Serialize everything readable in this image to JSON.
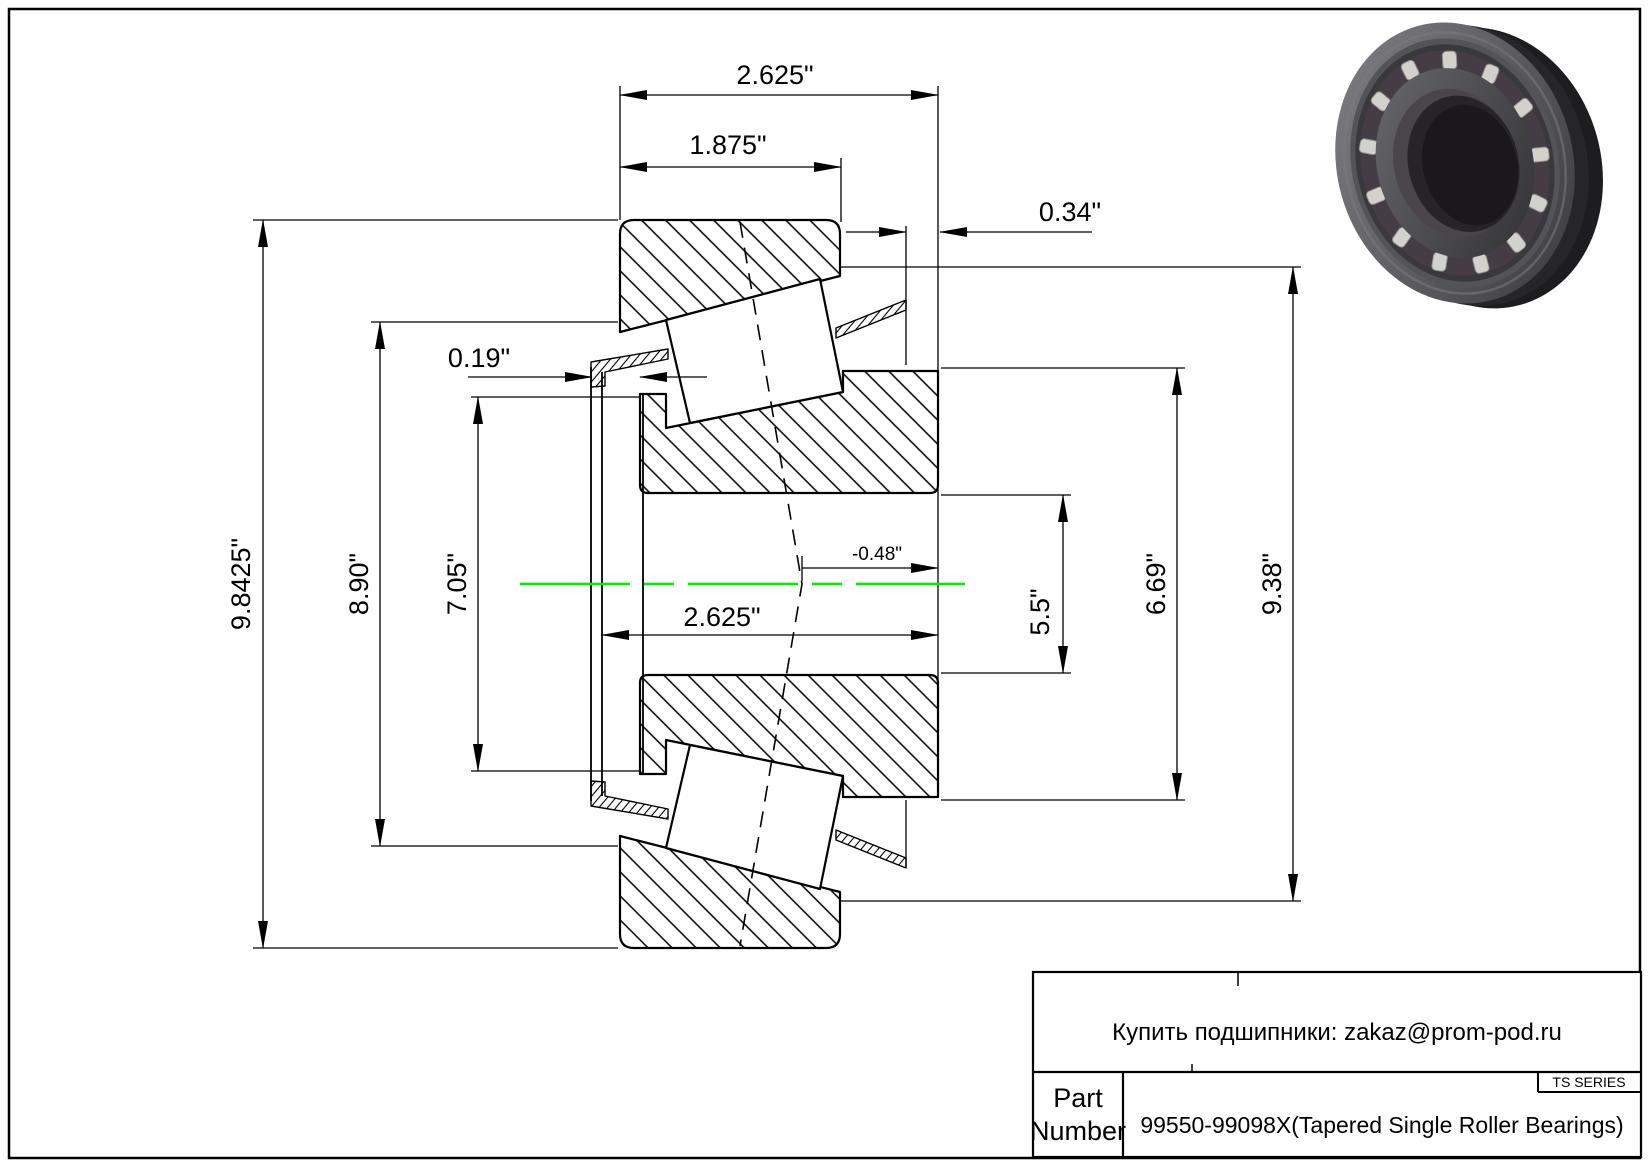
{
  "dims": {
    "total_width": "2.625\"",
    "cup_width": "1.875\"",
    "flange_standout": "0.34\"",
    "cage_protrusion": "0.19\"",
    "flange_od": "9.8425\"",
    "flange_back_diameter": "8.90\"",
    "front_face_diameter": "7.05\"",
    "cone_width": "2.625\"",
    "effective_center": "-0.48\"",
    "bore_diameter": "5.5\"",
    "cone_back_face_diameter": "6.69\"",
    "cup_od": "9.38\""
  },
  "title_block": {
    "contact": "Купить подшипники: zakaz@prom-pod.ru",
    "series": "TS SERIES",
    "part_label": {
      "line1": "Part",
      "line2": "Number"
    },
    "part_number": "99550-99098X(Tapered Single Roller Bearings)"
  },
  "colors": {
    "centerline": "#00ee00",
    "line": "#000000"
  }
}
